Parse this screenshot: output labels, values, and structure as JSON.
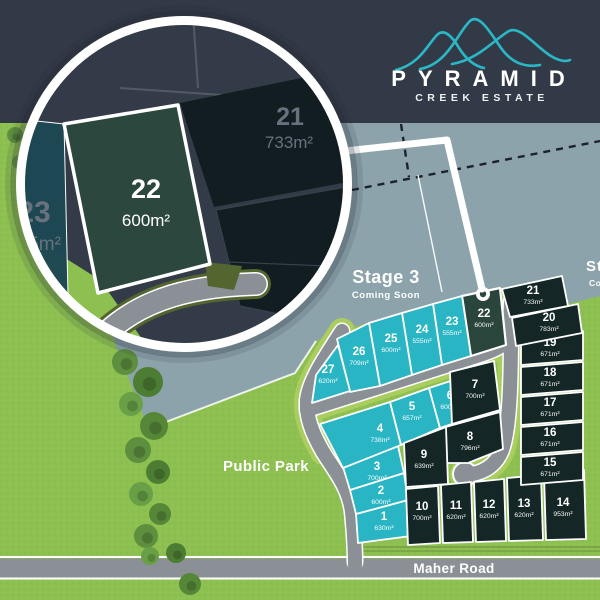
{
  "brand": {
    "name": "PYRAMID",
    "tagline": "CREEK ESTATE"
  },
  "stage3": {
    "label": "Stage 3",
    "sublabel": "Coming Soon"
  },
  "stage_edge": {
    "label": "Stage",
    "sublabel": "Coming"
  },
  "park": {
    "label": "Public Park"
  },
  "road": {
    "label": "Maher Road"
  },
  "magnifier": {
    "featured_lot": {
      "number": "22",
      "area": "600m²"
    },
    "neighbor_left": {
      "number": "23",
      "area": "555m²"
    },
    "neighbor_right": {
      "number": "21",
      "area": "733m²"
    }
  },
  "lots": [
    {
      "id": "1",
      "area": "630m²",
      "status": "available"
    },
    {
      "id": "2",
      "area": "600m²",
      "status": "available"
    },
    {
      "id": "3",
      "area": "700m²",
      "status": "available"
    },
    {
      "id": "4",
      "area": "738m²",
      "status": "available"
    },
    {
      "id": "5",
      "area": "657m²",
      "status": "available"
    },
    {
      "id": "6",
      "area": "600m²",
      "status": "available"
    },
    {
      "id": "7",
      "area": "700m²",
      "status": "unavailable"
    },
    {
      "id": "8",
      "area": "796m²",
      "status": "unavailable"
    },
    {
      "id": "9",
      "area": "639m²",
      "status": "unavailable"
    },
    {
      "id": "10",
      "area": "700m²",
      "status": "unavailable"
    },
    {
      "id": "11",
      "area": "620m²",
      "status": "unavailable"
    },
    {
      "id": "12",
      "area": "620m²",
      "status": "unavailable"
    },
    {
      "id": "13",
      "area": "620m²",
      "status": "unavailable"
    },
    {
      "id": "14",
      "area": "953m²",
      "status": "unavailable"
    },
    {
      "id": "15",
      "area": "671m²",
      "status": "unavailable"
    },
    {
      "id": "16",
      "area": "671m²",
      "status": "unavailable"
    },
    {
      "id": "17",
      "area": "671m²",
      "status": "unavailable"
    },
    {
      "id": "18",
      "area": "671m²",
      "status": "unavailable"
    },
    {
      "id": "19",
      "area": "671m²",
      "status": "unavailable"
    },
    {
      "id": "20",
      "area": "783m²",
      "status": "unavailable"
    },
    {
      "id": "21",
      "area": "733m²",
      "status": "unavailable"
    },
    {
      "id": "22",
      "area": "600m²",
      "status": "featured"
    },
    {
      "id": "23",
      "area": "555m²",
      "status": "available"
    },
    {
      "id": "24",
      "area": "555m²",
      "status": "available"
    },
    {
      "id": "25",
      "area": "600m²",
      "status": "available"
    },
    {
      "id": "26",
      "area": "709m²",
      "status": "available"
    },
    {
      "id": "27",
      "area": "620m²",
      "status": "available"
    }
  ],
  "colors": {
    "header_navy": "#333a47",
    "accent_teal": "#2ab8c6",
    "lot_available": "#2ab5c5",
    "lot_unavailable": "#142626",
    "lot_featured": "#2a463c",
    "future_area": "#8ca3ac",
    "grass": "#8dc051",
    "road": "#8a9095"
  }
}
